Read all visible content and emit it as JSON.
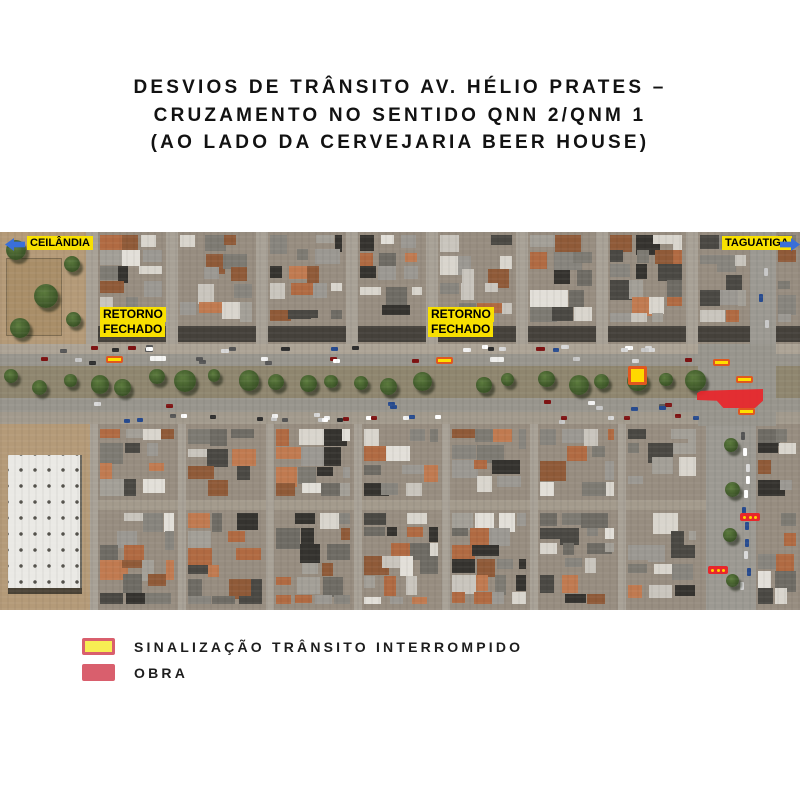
{
  "title": {
    "line1": "DESVIOS DE TRÂNSITO AV. HÉLIO PRATES –",
    "line2": "CRUZAMENTO NO SENTIDO QNN 2/QNM 1",
    "line3": "(AO LADO DA CERVEJARIA BEER HOUSE)"
  },
  "map": {
    "direction_labels": [
      {
        "text": "CEILÂNDIA",
        "arrow": "left"
      },
      {
        "text": "TAGUATIGA",
        "arrow": "right"
      }
    ],
    "road_closure_labels": [
      {
        "line1": "RETORNO",
        "line2": "FECHADO"
      },
      {
        "line1": "RETORNO",
        "line2": "FECHADO"
      }
    ],
    "markers": {
      "signal_bars": 5,
      "signal_squares": 1,
      "dotted_barriers": 2,
      "obra_zones": 1
    }
  },
  "legend": {
    "items": [
      {
        "label": "SINALIZAÇÃO TRÂNSITO INTERROMPIDO",
        "swatch_fill": "#f7ed53",
        "swatch_border": "#d95f6d"
      },
      {
        "label": "OBRA",
        "swatch_fill": "#d95f6d",
        "swatch_border": "#d95f6d"
      }
    ]
  },
  "colors": {
    "annotation_yellow": "#f8e000",
    "arrow_blue": "#3a6fd8",
    "marker_fill_yellow": "#ffe000",
    "marker_border_orange": "#e0581f",
    "obra_red": "#e8262b",
    "legend_red": "#d95f6d",
    "legend_yellow": "#f7ed53",
    "title_text": "#121212"
  }
}
